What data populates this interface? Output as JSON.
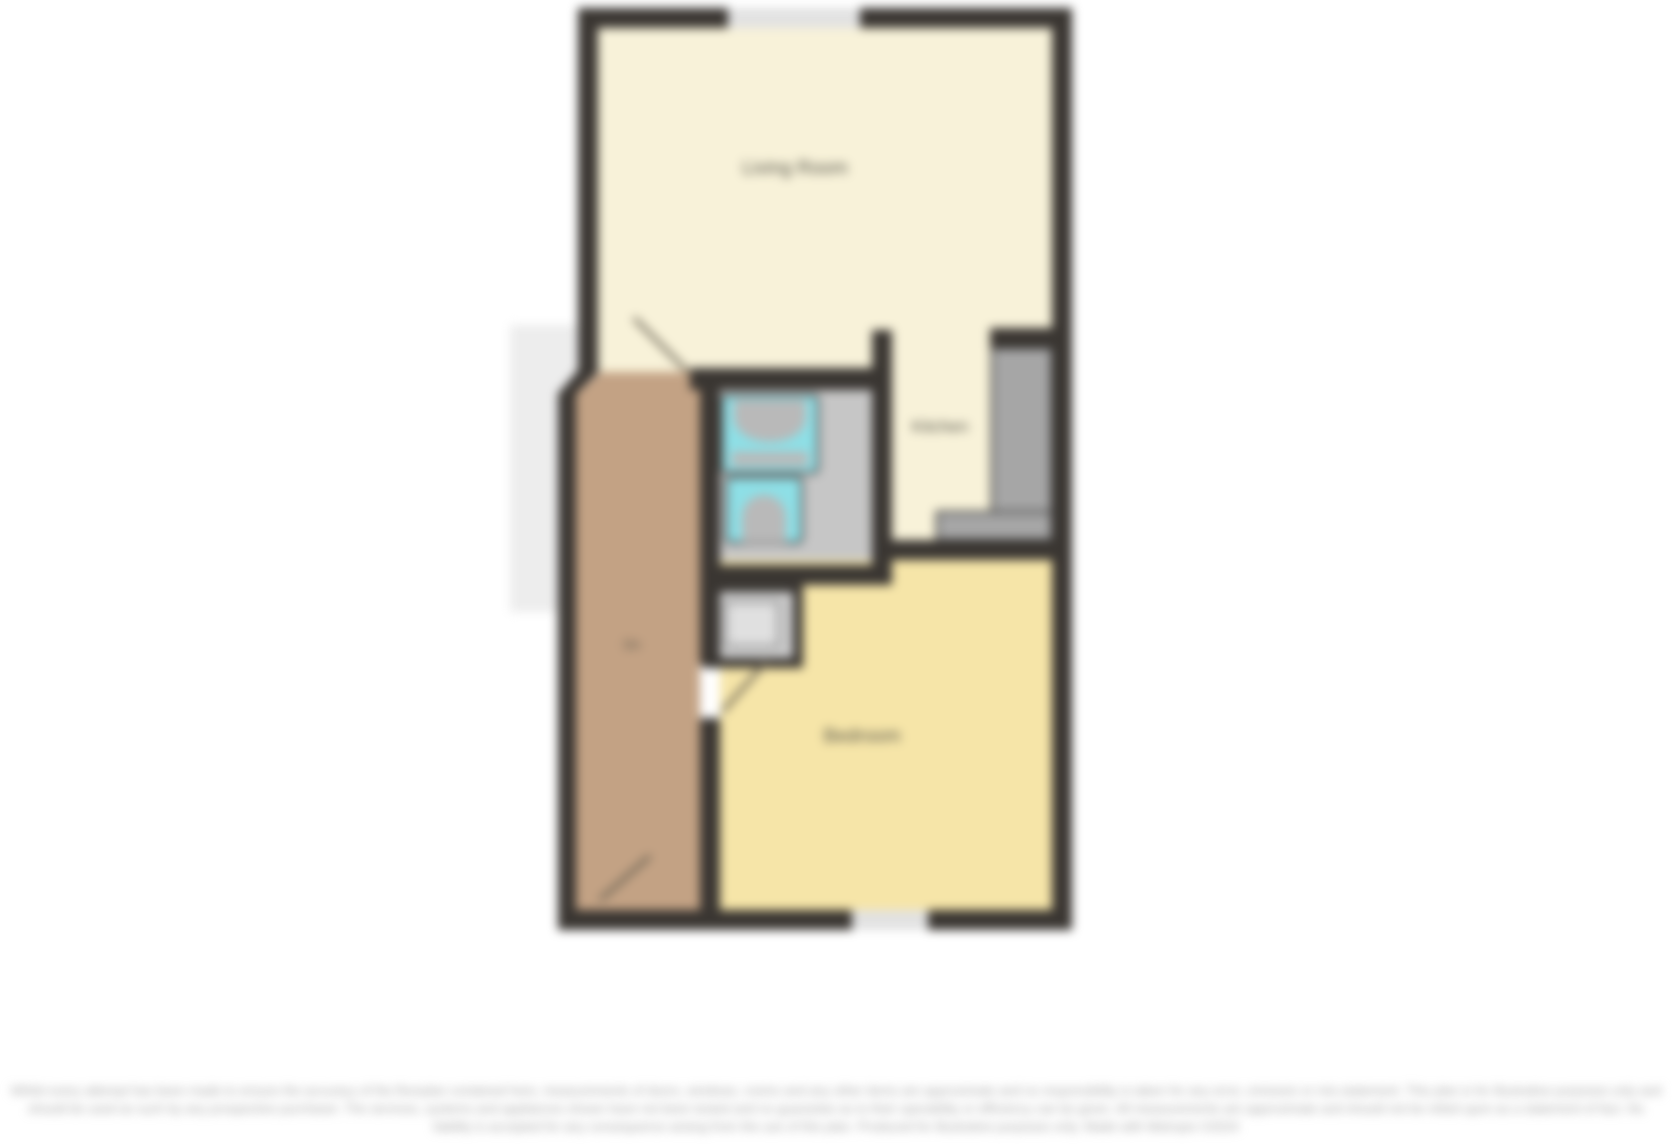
{
  "floorplan": {
    "title": "Flat floor plan",
    "labels": {
      "living_room": "Living Room",
      "kitchen": "Kitchen",
      "bedroom": "Bedroom",
      "stairs": "Dn"
    },
    "rooms": [
      {
        "name": "Living Room",
        "floor_color": "#f8f2d9",
        "position": "top"
      },
      {
        "name": "Kitchen",
        "floor_color": "#f8f2d9",
        "position": "middle-right",
        "features": [
          "counter-right",
          "counter-bottom"
        ]
      },
      {
        "name": "Bathroom",
        "floor_color": "#c6c6c6",
        "position": "middle-left",
        "features": [
          "bath",
          "toilet"
        ]
      },
      {
        "name": "Bedroom",
        "floor_color": "#f6e5a8",
        "position": "bottom"
      },
      {
        "name": "Hallway / Stairs",
        "floor_color": "#c3a284",
        "position": "left",
        "features": [
          "stairs-down",
          "door-swing"
        ]
      },
      {
        "name": "Cupboard",
        "floor_color": "#cbcbcb",
        "position": "center",
        "features": [
          "storage-unit"
        ]
      }
    ],
    "windows": [
      {
        "wall": "top",
        "note": "window gap in top exterior wall"
      },
      {
        "wall": "bottom",
        "note": "window gap in bottom exterior wall"
      }
    ],
    "colors": {
      "wall": "#3a3632",
      "living_room_floor": "#f8f2d9",
      "bedroom_floor": "#f6e5a8",
      "hallway_floor": "#c3a284",
      "bathroom_floor": "#c6c6c6",
      "fixture_cyan": "#8edfe6",
      "fixture_inner_gray": "#b9b9b9",
      "counter_gray": "#a6a6a6",
      "cupboard_gray": "#cbcbcb",
      "window_fill": "#e2e2e2",
      "watermark_band": "#ededed",
      "label_text": "#55544a",
      "disclaimer_text": "#9f9f9f",
      "background": "#ffffff"
    }
  },
  "disclaimer": {
    "text": "Whilst every attempt has been made to ensure the accuracy of the floorplan contained here, measurements of doors, windows, rooms and any other items are approximate and no responsibility is taken for any error, omission or mis-statement. This plan is for illustrative purposes only and should be used as such by any prospective purchaser. The services, systems and appliances shown have not been tested and no guarantee as to their operability or efficiency can be given. All measurements are approximate and should not be relied upon as a statement of fact. No liability is accepted for any consequence arising from the use of this plan. Produced for illustrative purposes only. Made with Metropix ©2024"
  }
}
